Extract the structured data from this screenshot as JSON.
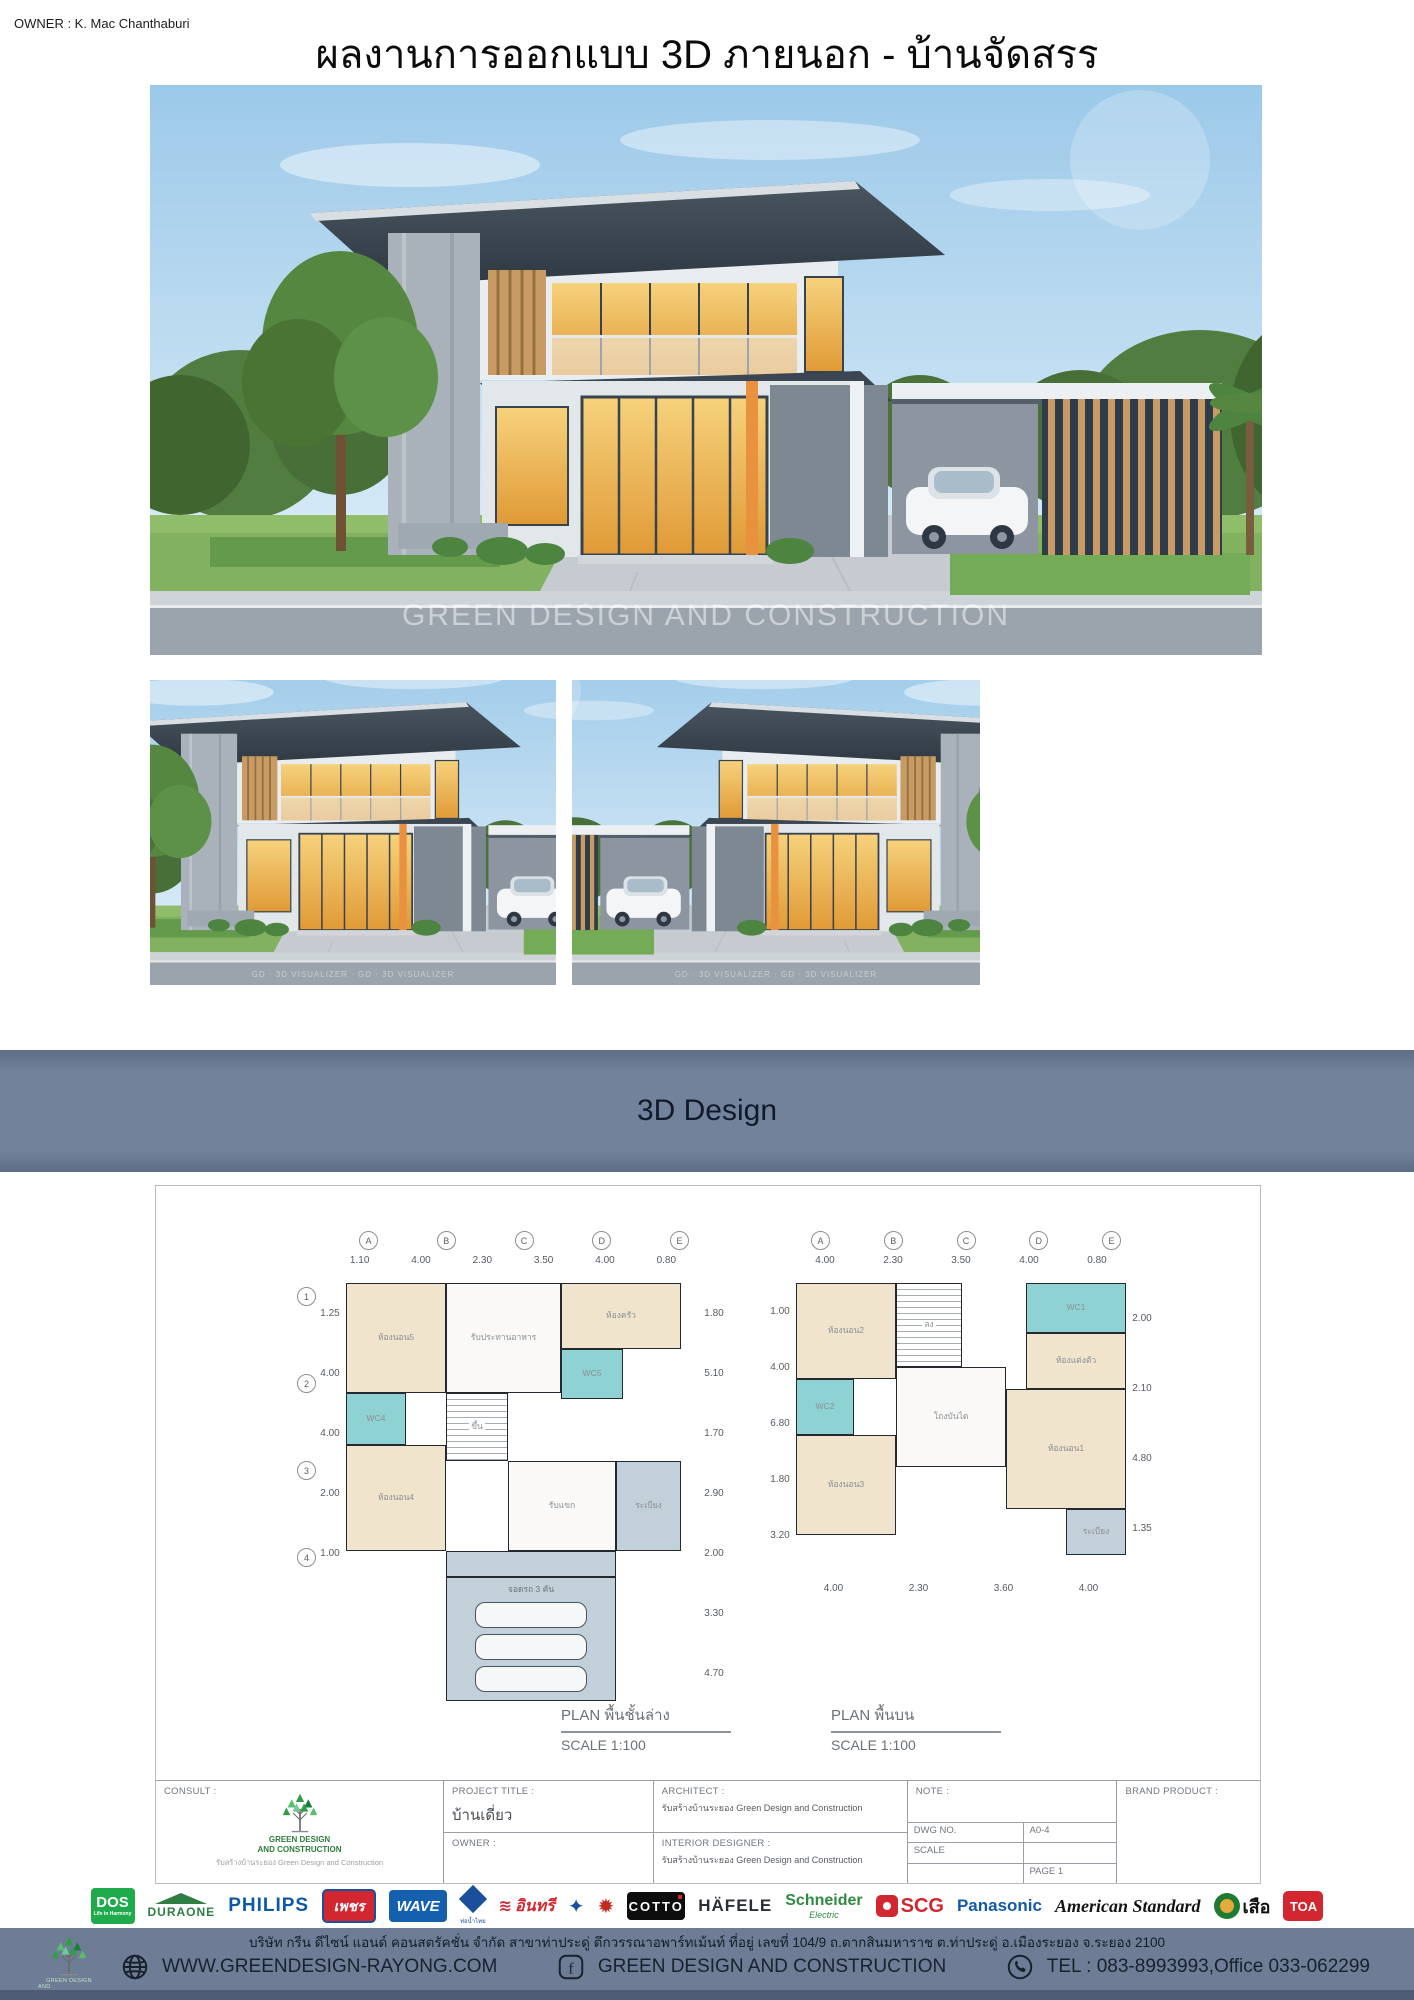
{
  "page": {
    "owner_label": "OWNER : K. Mac Chanthaburi",
    "title": "ผลงานการออกแบบ 3D ภายนอก - บ้านจัดสรร"
  },
  "renders": {
    "main_watermark": "GREEN DESIGN AND CONSTRUCTION",
    "small_watermark": "GD · 3D VISUALIZER · GD · 3D VISUALIZER"
  },
  "banner": {
    "label": "3D Design"
  },
  "plans": {
    "left": {
      "caption": "PLAN พื้นชั้นล่าง",
      "scale": "SCALE 1:100",
      "grid_cols": [
        "A",
        "B",
        "C",
        "D",
        "E"
      ],
      "grid_rows": [
        "1",
        "2",
        "3",
        "4"
      ],
      "dims_top": [
        "1.10",
        "4.00",
        "2.30",
        "3.50",
        "4.00",
        "0.80"
      ],
      "dims_left": [
        "1.25",
        "4.00",
        "4.00",
        "2.00",
        "1.00"
      ],
      "dims_right": [
        "1.80",
        "5.10",
        "1.70",
        "2.90",
        "2.00",
        "3.30",
        "4.70"
      ],
      "rooms": {
        "bedroom5": "ห้องนอน5",
        "wc4": "WC4",
        "bedroom4": "ห้องนอน4",
        "stair": "ขึ้น",
        "dining": "รับประทานอาหาร",
        "kitchen": "ห้องครัว",
        "wc5": "WC5",
        "living": "รับแขก",
        "balcony": "ระเบียง",
        "carport": "จอดรถ 3 คัน"
      }
    },
    "right": {
      "caption": "PLAN พื้นบน",
      "scale": "SCALE 1:100",
      "grid_cols": [
        "A",
        "B",
        "C",
        "D",
        "E"
      ],
      "dims_top": [
        "4.00",
        "2.30",
        "3.50",
        "4.00",
        "0.80"
      ],
      "dims_left": [
        "1.00",
        "4.00",
        "6.80",
        "1.80",
        "3.20"
      ],
      "dims_right": [
        "2.00",
        "2.10",
        "4.80",
        "1.35"
      ],
      "dims_bottom": [
        "4.00",
        "2.30",
        "3.60",
        "4.00"
      ],
      "rooms": {
        "bedroom2": "ห้องนอน2",
        "stair": "ลง",
        "wc1": "WC1",
        "dressing": "ห้องแต่งตัว",
        "wc2": "WC2",
        "hall": "โถงบันได",
        "bedroom3": "ห้องนอน3",
        "bedroom1": "ห้องนอน1",
        "balcony": "ระเบียง"
      }
    }
  },
  "titleblock": {
    "consult_label": "CONSULT :",
    "consult_sub": "รับสร้างบ้านระยอง Green Design and Construction",
    "project_label": "PROJECT TITLE :",
    "project_value": "บ้านเดี่ยว",
    "owner_label": "OWNER :",
    "architect_label": "ARCHITECT :",
    "architect_value": "รับสร้างบ้านระยอง Green Design and Construction",
    "interior_label": "INTERIOR DESIGNER :",
    "interior_value": "รับสร้างบ้านระยอง Green Design and Construction",
    "note_label": "NOTE :",
    "dwg_label": "DWG NO.",
    "dwg_value": "A0-4",
    "scale_label": "SCALE",
    "scale_value": "",
    "page_value": "PAGE 1",
    "brand_label": "BRAND PRODUCT :"
  },
  "logo": {
    "line1": "GREEN DESIGN",
    "line2": "AND CONSTRUCTION"
  },
  "brands": [
    {
      "label": "DOS",
      "sub": "Life in Harmony"
    },
    {
      "label": "DURAONE"
    },
    {
      "label": "PHILIPS"
    },
    {
      "label": "เพชร"
    },
    {
      "label": "WAVE"
    },
    {
      "label": "ท่อน้ำไทย"
    },
    {
      "label": "อินทรี",
      "icon": "≋"
    },
    {
      "icon": "✦"
    },
    {
      "icon": "✹"
    },
    {
      "label": "COTTO"
    },
    {
      "label": "HÄFELE"
    },
    {
      "label": "Schneider",
      "sub": "Electric"
    },
    {
      "label": "SCG"
    },
    {
      "label": "Panasonic"
    },
    {
      "label": "American Standard"
    },
    {
      "label": "เสือ"
    },
    {
      "label": "TOA"
    }
  ],
  "footer": {
    "company_line": "บริษัท กรีน ดีไซน์ แอนด์ คอนสตรัคชั่น จำกัด สาขาท่าประดู่ ตึกวรรณาอพาร์ทเม้นท์ ที่อยู่ เลขที่ 104/9  ถ.ตากสินมหาราช  ต.ท่าประดู่ อ.เมืองระยอง  จ.ระยอง 2100",
    "website": "WWW.GREENDESIGN-RAYONG.COM",
    "facebook": "GREEN DESIGN AND CONSTRUCTION",
    "tel": "TEL : 083-8993993,Office 033-062299"
  },
  "icons": {
    "facebook": "f"
  }
}
